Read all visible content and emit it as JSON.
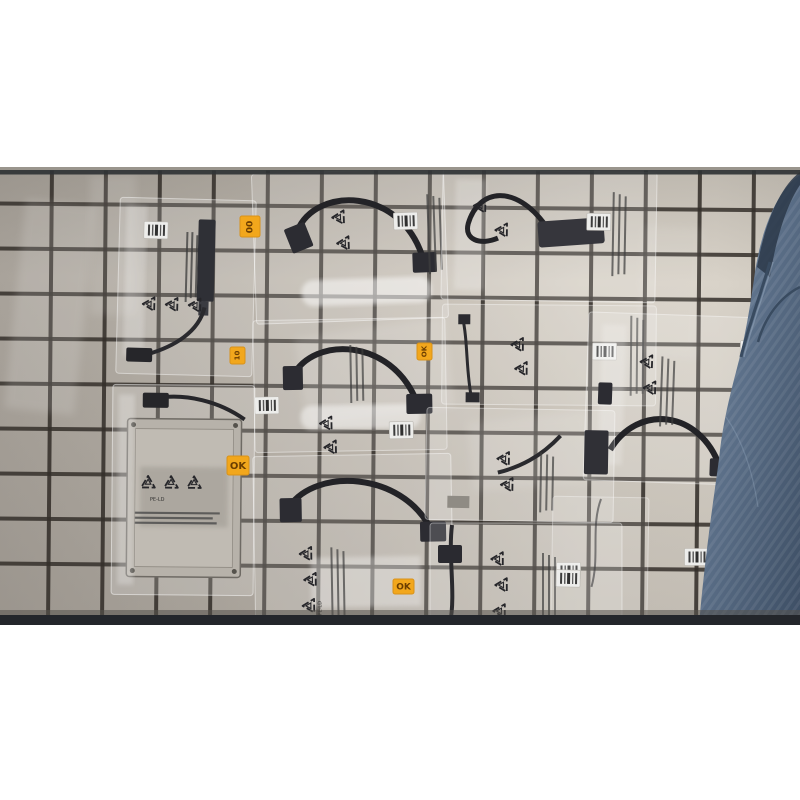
{
  "photo": {
    "stickers": [
      {
        "label": "00"
      },
      {
        "label": "10"
      },
      {
        "label": "OK"
      },
      {
        "label": "OK"
      },
      {
        "label": "OK"
      }
    ],
    "recycle_label": "PE-LD",
    "colors": {
      "page_background": "#ffffff",
      "mat_tile": "#c6bfb5",
      "grid_line": "#342f2a",
      "sticker_orange": "#f2a71c",
      "jeans_blue": "#5c7089",
      "plastic_bag_highlight": "#ffffff",
      "cable_black": "#232327"
    }
  }
}
